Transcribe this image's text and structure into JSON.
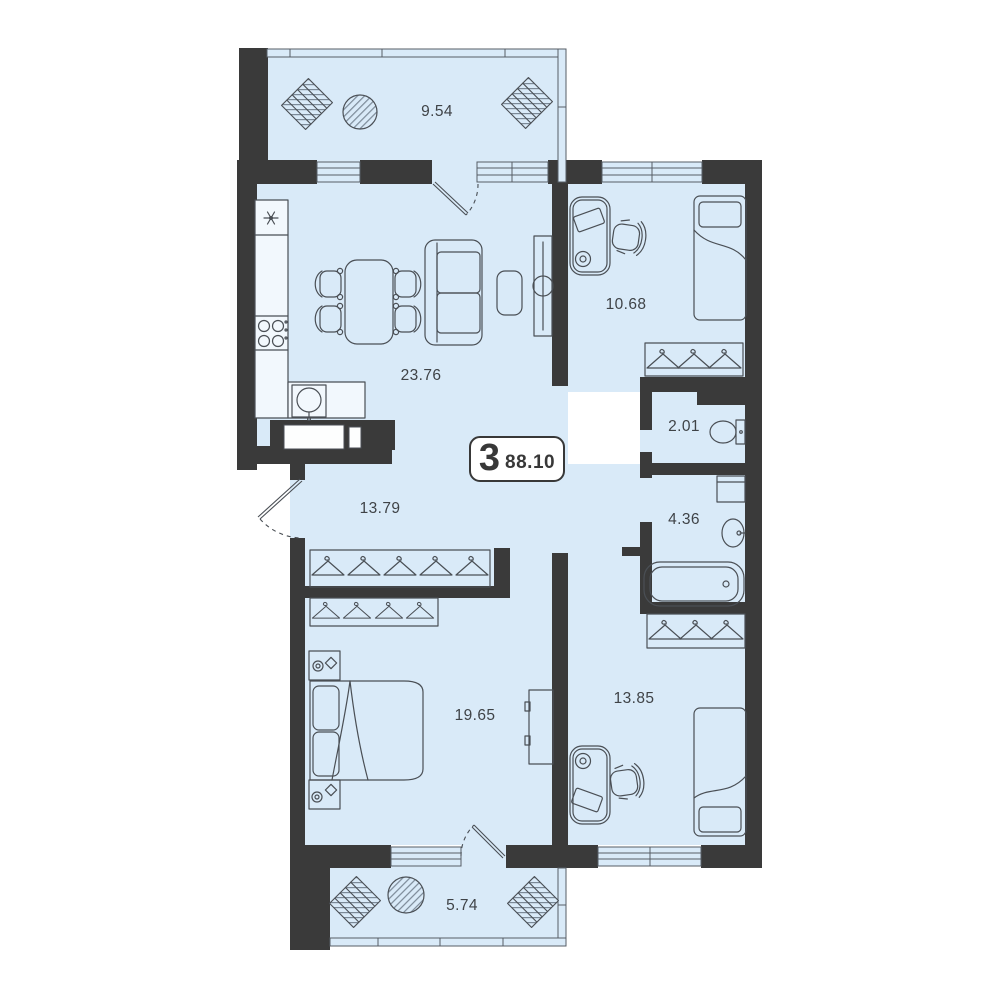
{
  "floorplan": {
    "badge": {
      "rooms_count": "3",
      "total_area": "88.10"
    },
    "rooms": [
      {
        "name": "balcony-top",
        "area": "9.54"
      },
      {
        "name": "kitchen-living",
        "area": "23.76"
      },
      {
        "name": "bedroom-1",
        "area": "10.68"
      },
      {
        "name": "wc",
        "area": "2.01"
      },
      {
        "name": "hallway",
        "area": "13.79"
      },
      {
        "name": "bathroom",
        "area": "4.36"
      },
      {
        "name": "bedroom-2",
        "area": "19.65"
      },
      {
        "name": "bedroom-3",
        "area": "13.85"
      },
      {
        "name": "balcony-bottom",
        "area": "5.74"
      }
    ],
    "colors": {
      "wall": "#3a3a3a",
      "room_fill": "#d9eaf8",
      "furniture_line": "#4a4f55",
      "text": "#3f4347",
      "background": "#ffffff",
      "badge_border": "#383838"
    },
    "icons": [
      "fridge-icon",
      "cooktop-icon",
      "kitchen-sink-icon",
      "dining-table-icon",
      "dining-chair-icon",
      "sofa-icon",
      "coffee-table-icon",
      "tv-stand-icon",
      "desk-icon",
      "desk-chair-icon",
      "single-bed-icon",
      "double-bed-icon",
      "nightstand-icon",
      "wardrobe-icon",
      "hanger-icon",
      "toilet-icon",
      "washing-machine-icon",
      "bathroom-sink-icon",
      "bathtub-icon",
      "lounge-chair-icon",
      "balcony-table-icon",
      "door-swing-icon",
      "window-icon"
    ]
  }
}
